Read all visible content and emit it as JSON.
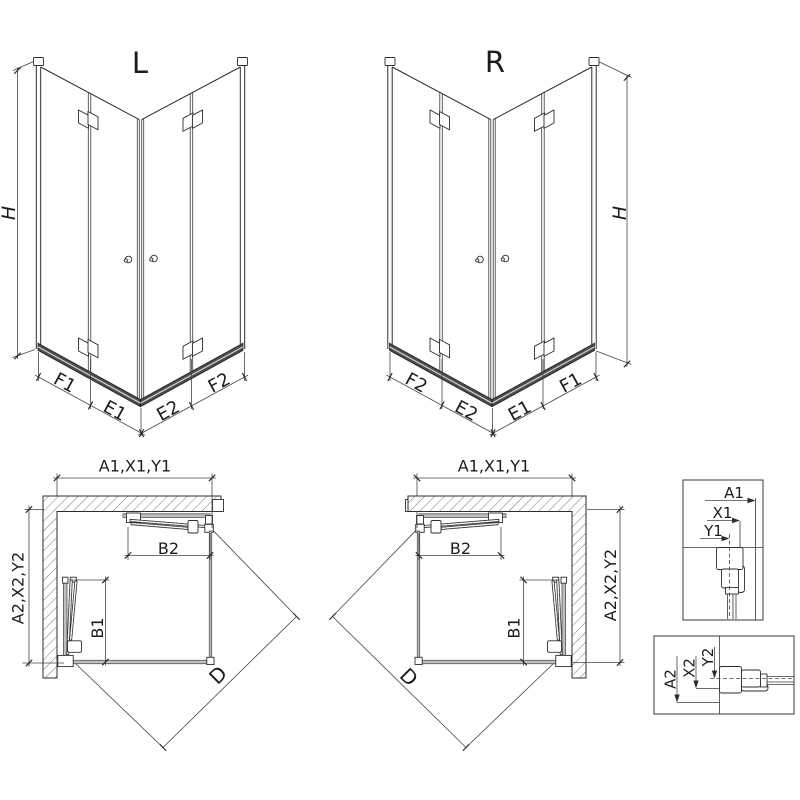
{
  "iso_left": {
    "title": "L",
    "h": "H",
    "seg1": "F1",
    "seg2": "E1",
    "seg3": "E2",
    "seg4": "F2"
  },
  "iso_right": {
    "title": "R",
    "h": "H",
    "seg1": "F2",
    "seg2": "E2",
    "seg3": "E1",
    "seg4": "F1"
  },
  "plan_left": {
    "dim_top": "A1,X1,Y1",
    "dim_side": "A2,X2,Y2",
    "dim_b2": "B2",
    "dim_b1": "B1",
    "dim_d": "D"
  },
  "plan_right": {
    "dim_top": "A1,X1,Y1",
    "dim_side": "A2,X2,Y2",
    "dim_b2": "B2",
    "dim_b1": "B1",
    "dim_d": "D"
  },
  "detail_top": {
    "a1": "A1",
    "x1": "X1",
    "y1": "Y1"
  },
  "detail_bottom": {
    "a2": "A2",
    "x2": "X2",
    "y2": "Y2"
  },
  "colors": {
    "line": "#2e2e2e",
    "rail_dark": "#4d4d4d",
    "rail_light": "#bfbfbf",
    "hatch": "#6a6a6a",
    "background": "#ffffff"
  }
}
